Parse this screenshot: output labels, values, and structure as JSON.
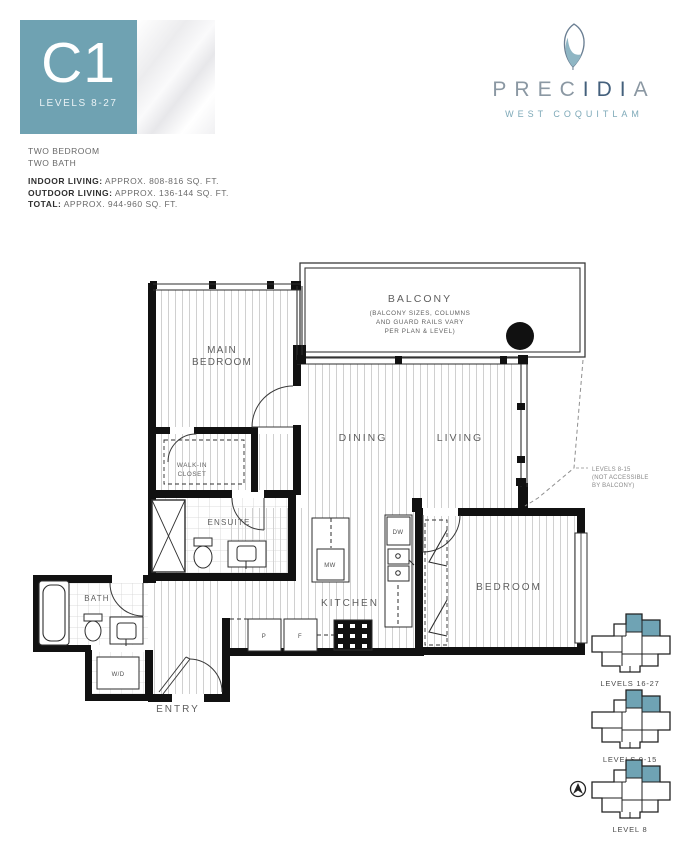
{
  "badge": {
    "plan_code": "C1",
    "levels": "LEVELS 8-27"
  },
  "logo": {
    "name_part1": "PREC",
    "name_part2": "IDI",
    "name_part3": "A",
    "location": "WEST COQUITLAM"
  },
  "summary": {
    "line1": "TWO BEDROOM",
    "line2": "TWO BATH",
    "indoor_label": "INDOOR LIVING:",
    "indoor_value": " APPROX. 808-816 SQ. FT.",
    "outdoor_label": "OUTDOOR LIVING:",
    "outdoor_value": " APPROX. 136-144 SQ. FT.",
    "total_label": "TOTAL:",
    "total_value": " APPROX. 944-960 SQ. FT."
  },
  "plan": {
    "rooms": {
      "balcony": "BALCONY",
      "balcony_note1": "(BALCONY SIZES, COLUMNS",
      "balcony_note2": "AND GUARD RAILS VARY",
      "balcony_note3": "PER PLAN & LEVEL)",
      "main_bedroom1": "MAIN",
      "main_bedroom2": "BEDROOM",
      "walkin1": "WALK-IN",
      "walkin2": "CLOSET",
      "dining": "DINING",
      "living": "LIVING",
      "ensuite": "ENSUITE",
      "bath": "BATH",
      "kitchen": "KITCHEN",
      "bedroom": "BEDROOM",
      "entry": "ENTRY",
      "wd": "W/D",
      "mw": "MW",
      "dw": "DW",
      "pantry": "P",
      "fridge": "F"
    },
    "note": {
      "line1": "LEVELS 8-15",
      "line2": "(NOT ACCESSIBLE",
      "line3": "BY BALCONY)"
    }
  },
  "keyplans": [
    {
      "label": "LEVELS 16-27"
    },
    {
      "label": "LEVELS 9-15"
    },
    {
      "label": "LEVEL 8"
    }
  ],
  "colors": {
    "accent": "#6fa2b2",
    "navy": "#44607c",
    "gray": "#8b98a3"
  }
}
